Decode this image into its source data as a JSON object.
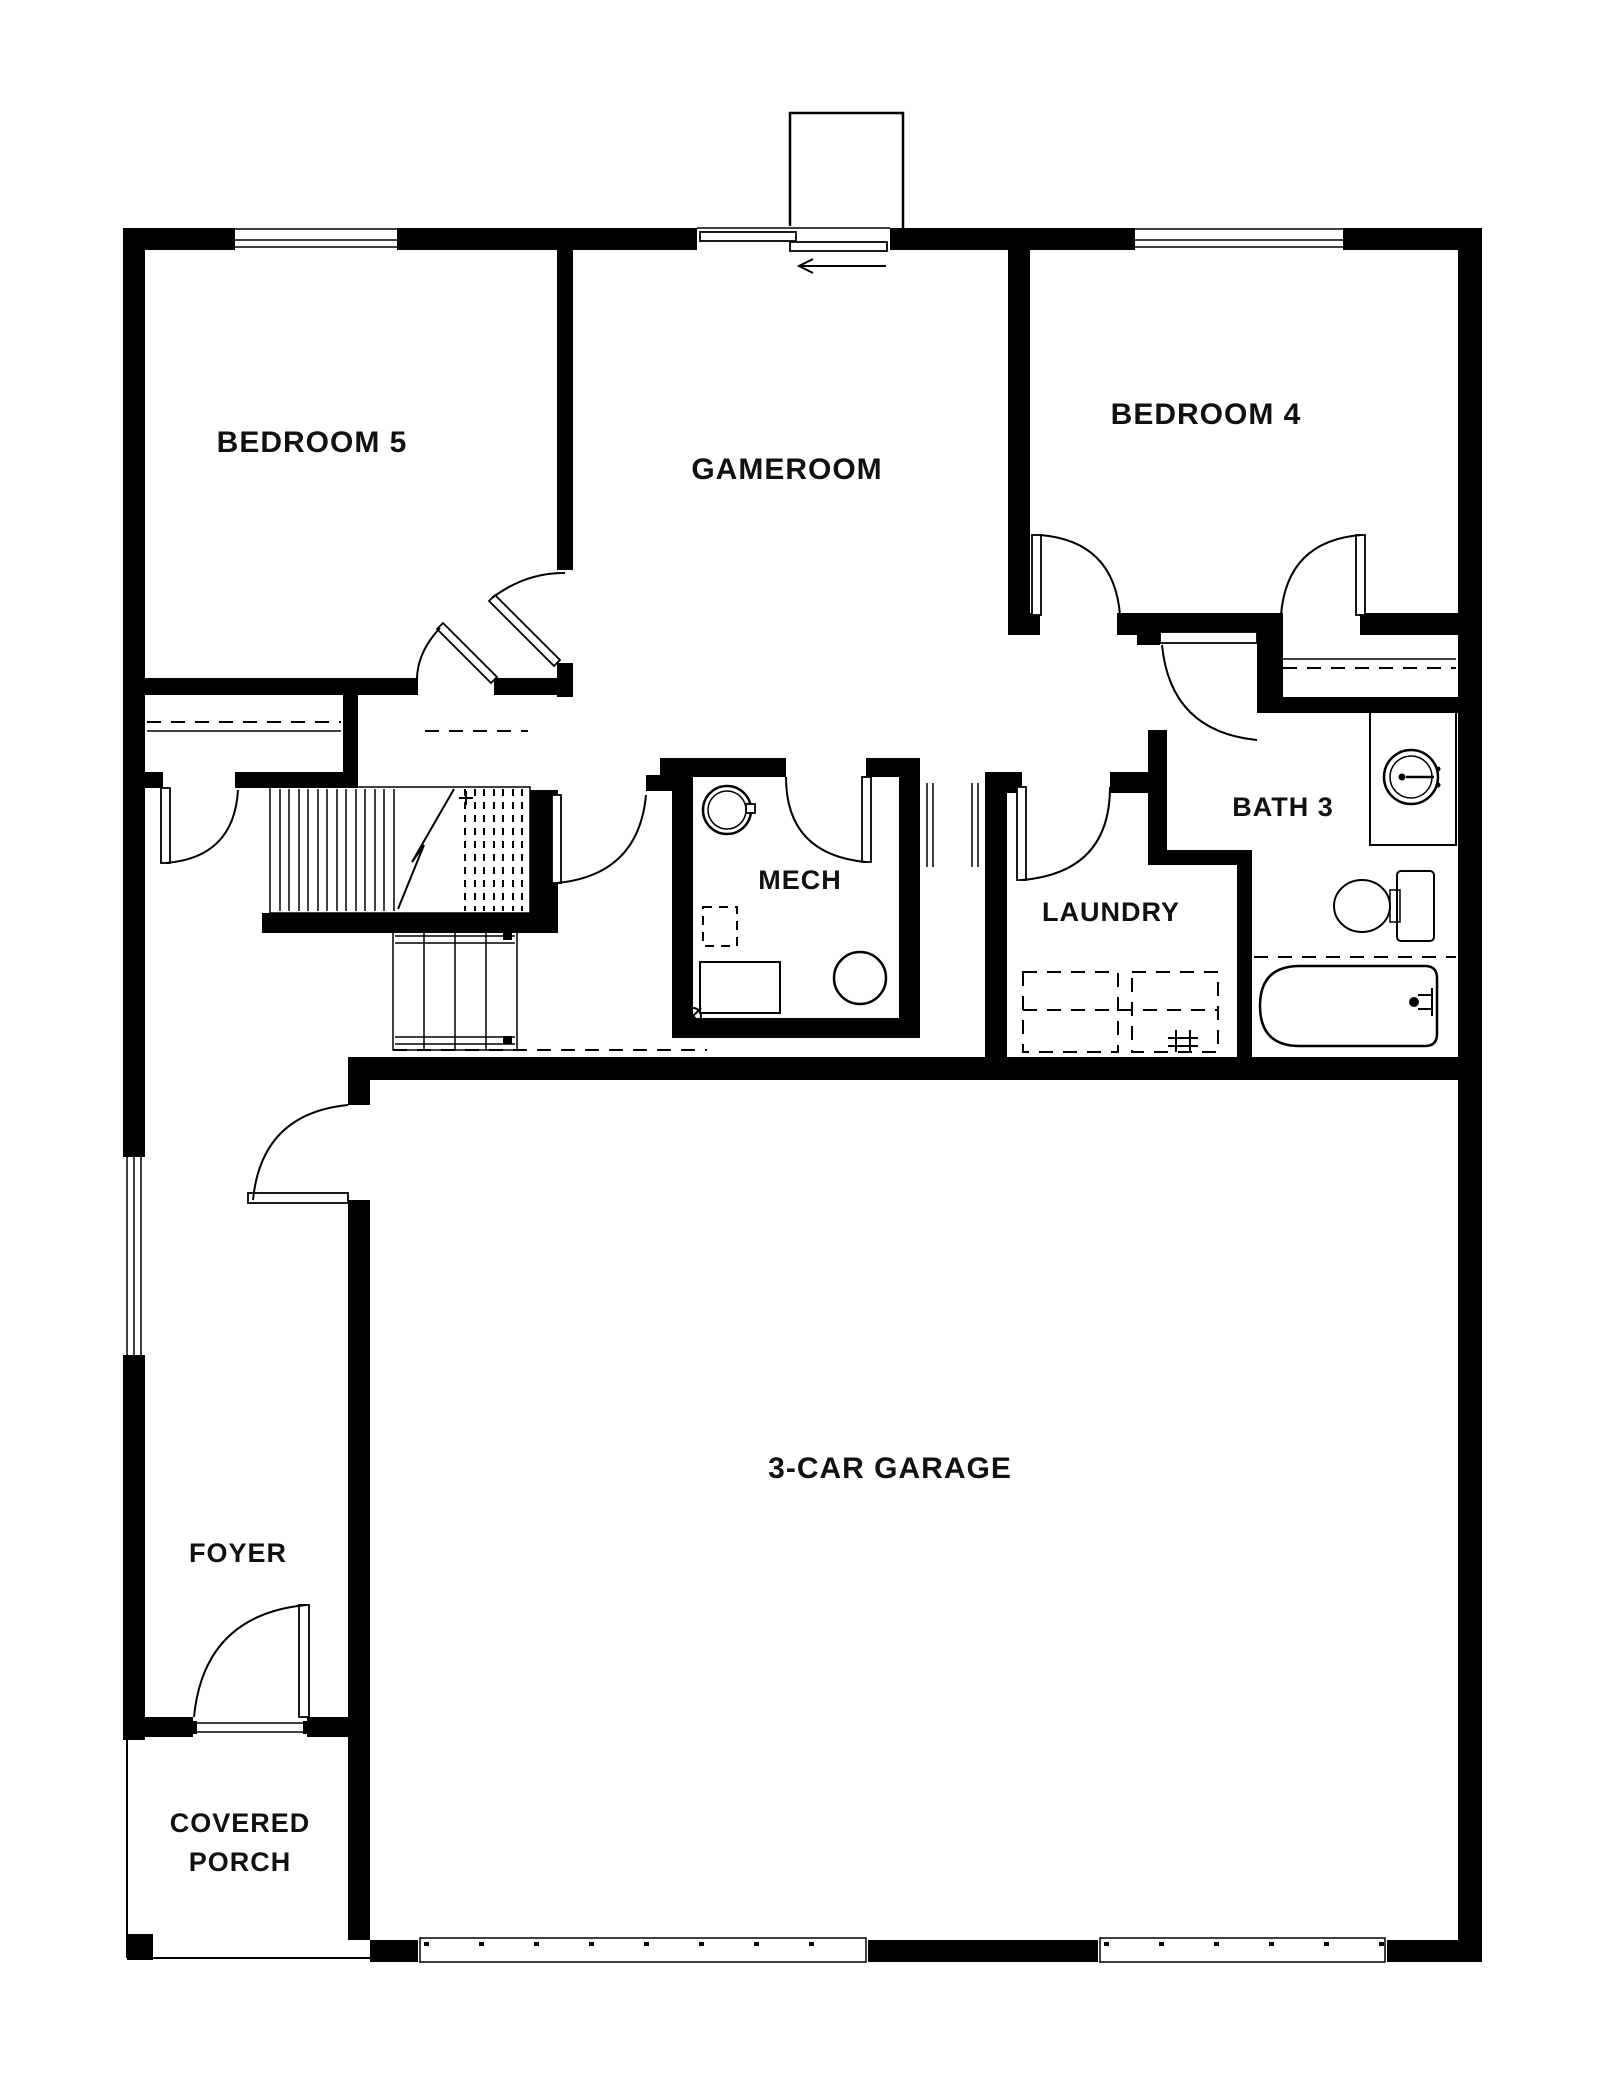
{
  "plan": {
    "title": "single floor plan drawing, black walls on white background",
    "rooms": {
      "bedroom5": {
        "label": "BEDROOM 5"
      },
      "gameroom": {
        "label": "GAMEROOM"
      },
      "bedroom4": {
        "label": "BEDROOM 4"
      },
      "bath3": {
        "label": "BATH 3"
      },
      "mech": {
        "label": "MECH"
      },
      "laundry": {
        "label": "LAUNDRY"
      },
      "garage": {
        "label": "3-CAR GARAGE"
      },
      "foyer": {
        "label": "FOYER"
      },
      "covered_porch": {
        "label_line1": "COVERED",
        "label_line2": "PORCH"
      }
    },
    "colors": {
      "wall": "#000000",
      "floor": "#ffffff",
      "line": "#111111"
    },
    "fixtures": [
      {
        "room": "mech",
        "items": [
          "water-heater-circle",
          "equipment-circle",
          "hvac-dashed-square",
          "equipment-rectangle",
          "floor-drain"
        ]
      },
      {
        "room": "laundry",
        "items": [
          "washer-dashed-square",
          "dryer-dashed-square",
          "laundry-hookup-marks"
        ]
      },
      {
        "room": "bath3",
        "items": [
          "vanity-with-round-sink",
          "toilet",
          "bathtub-with-curtain-dashes"
        ]
      }
    ],
    "features": {
      "sliding_door_arrow_direction": "left",
      "stairs": "two runs with landing, break line and dashed upper treads",
      "garage_door_openings": 2,
      "windows": [
        "bedroom5-top",
        "bedroom4-top",
        "foyer-left-side"
      ],
      "chimney_bump_top": true,
      "porch_post_bottom_left": true
    }
  }
}
